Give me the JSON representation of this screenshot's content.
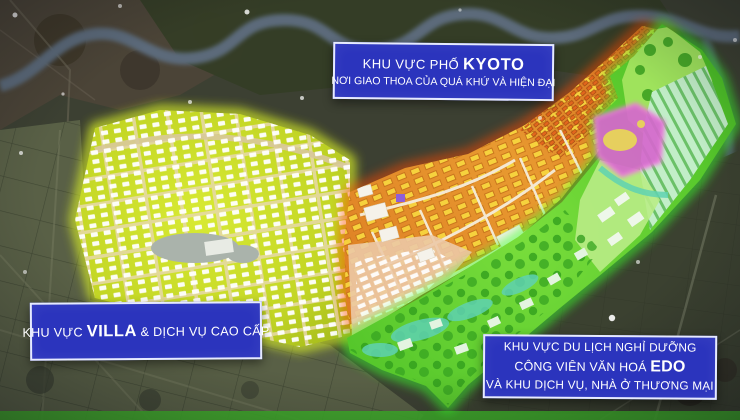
{
  "labels": {
    "kyoto": {
      "line1_prefix": "KHU VỰC PHỐ ",
      "line1_bold": "KYOTO",
      "line2": "NƠI GIAO THOA CỦA QUÁ KHỨ VÀ HIỆN ĐẠI"
    },
    "villa": {
      "prefix": "KHU VỰC ",
      "bold": "VILLA",
      "suffix": " & DỊCH VỤ CAO CẤP"
    },
    "edo": {
      "line1": "KHU VỰC DU LỊCH NGHỈ DƯỠNG",
      "line2_prefix": "CÔNG VIÊN VĂN HOÁ ",
      "line2_bold": "EDO",
      "line3": "VÀ KHU DỊCH VỤ, NHÀ Ở THƯƠNG MẠI"
    }
  },
  "colors": {
    "label_box": "#2b34bd",
    "label_border": "#e6eaff",
    "label_text": "#ffffff",
    "villa_fill": "#c6d929",
    "villa_glow": "#d9f128",
    "kyoto_fill": "#e08a26",
    "kyoto_glow": "#ff4a00",
    "edo_fill": "#5ccc2e",
    "edo_glow": "#3dff2e",
    "bottom_strip": "#3fae2a"
  }
}
